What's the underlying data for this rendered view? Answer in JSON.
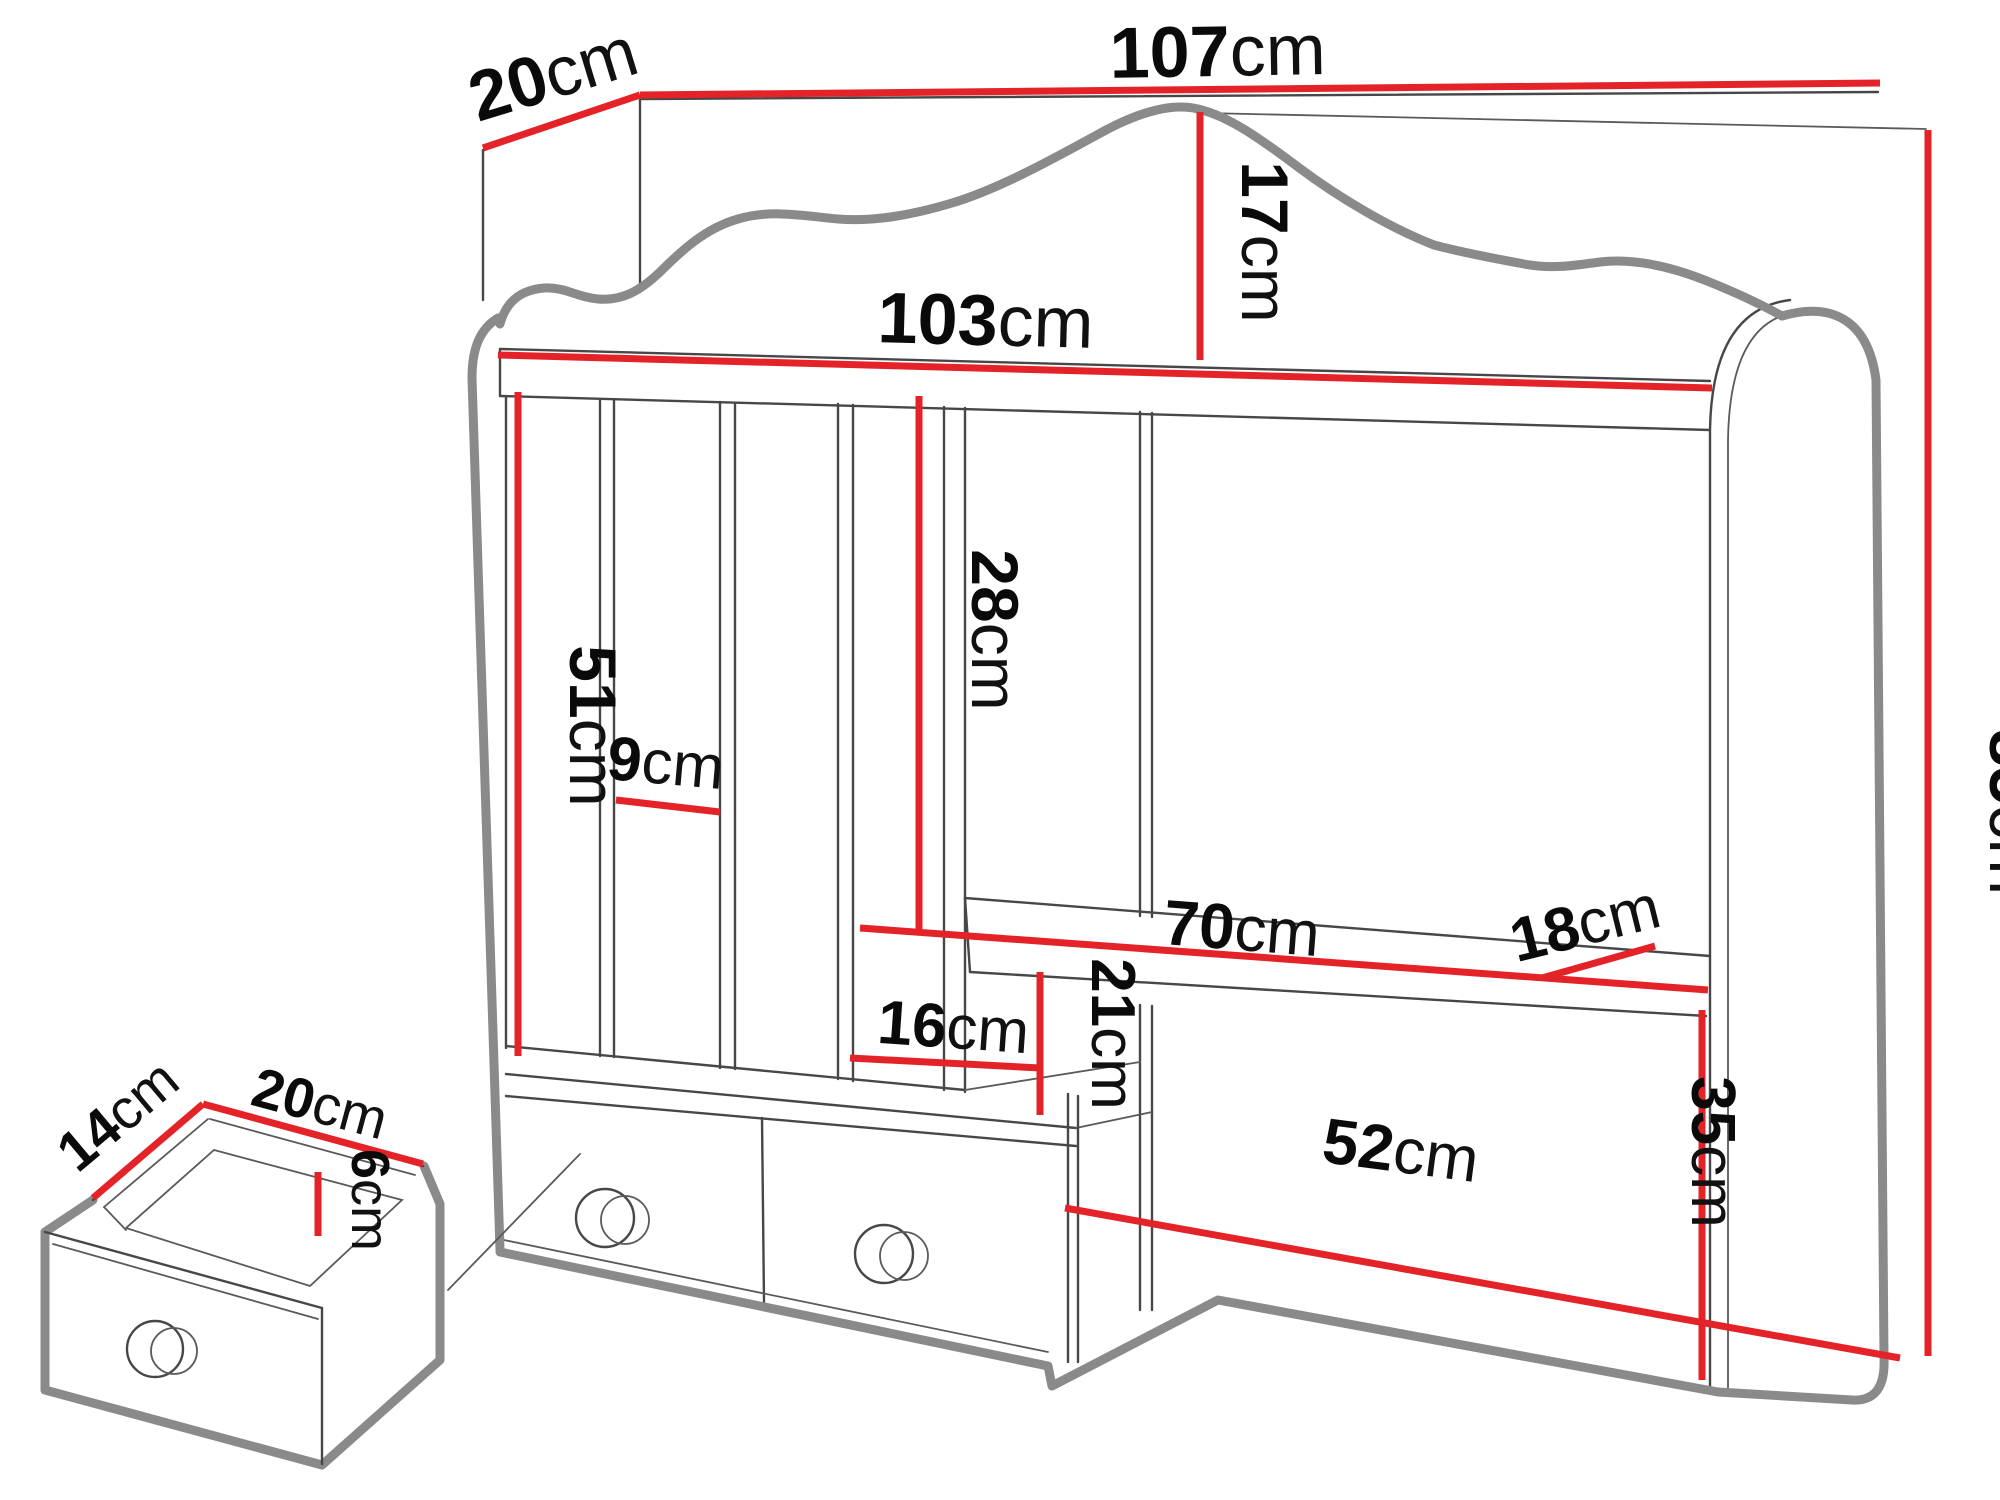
{
  "diagram": {
    "type": "furniture-dimension-drawing",
    "subject": "desk hutch / wall organizer with magazine slots, two drawers and detached drawer detail",
    "unit": "cm",
    "colors": {
      "dimension_line": "#e42328",
      "outline_thick": "#8a8a8a",
      "outline_thin": "#474747",
      "label_text": "#0a0a0a",
      "background": "#ffffff"
    },
    "dimensions": {
      "top_depth": {
        "value": "20",
        "unit": "cm"
      },
      "total_width": {
        "value": "107",
        "unit": "cm"
      },
      "crest_height": {
        "value": "17",
        "unit": "cm"
      },
      "shelf_width": {
        "value": "103",
        "unit": "cm"
      },
      "slot_height": {
        "value": "51",
        "unit": "cm"
      },
      "slot_width": {
        "value": "9",
        "unit": "cm"
      },
      "upper_opening_height": {
        "value": "28",
        "unit": "cm"
      },
      "middle_shelf_width": {
        "value": "70",
        "unit": "cm"
      },
      "middle_shelf_depth": {
        "value": "18",
        "unit": "cm"
      },
      "total_height": {
        "value": "85",
        "unit": "cm"
      },
      "cubby_width": {
        "value": "16",
        "unit": "cm"
      },
      "cubby_height": {
        "value": "21",
        "unit": "cm"
      },
      "lower_opening_width": {
        "value": "52",
        "unit": "cm"
      },
      "lower_opening_height": {
        "value": "35",
        "unit": "cm"
      },
      "drawer_depth": {
        "value": "14",
        "unit": "cm"
      },
      "drawer_width": {
        "value": "20",
        "unit": "cm"
      },
      "drawer_inner_height": {
        "value": "6",
        "unit": "cm"
      }
    }
  }
}
